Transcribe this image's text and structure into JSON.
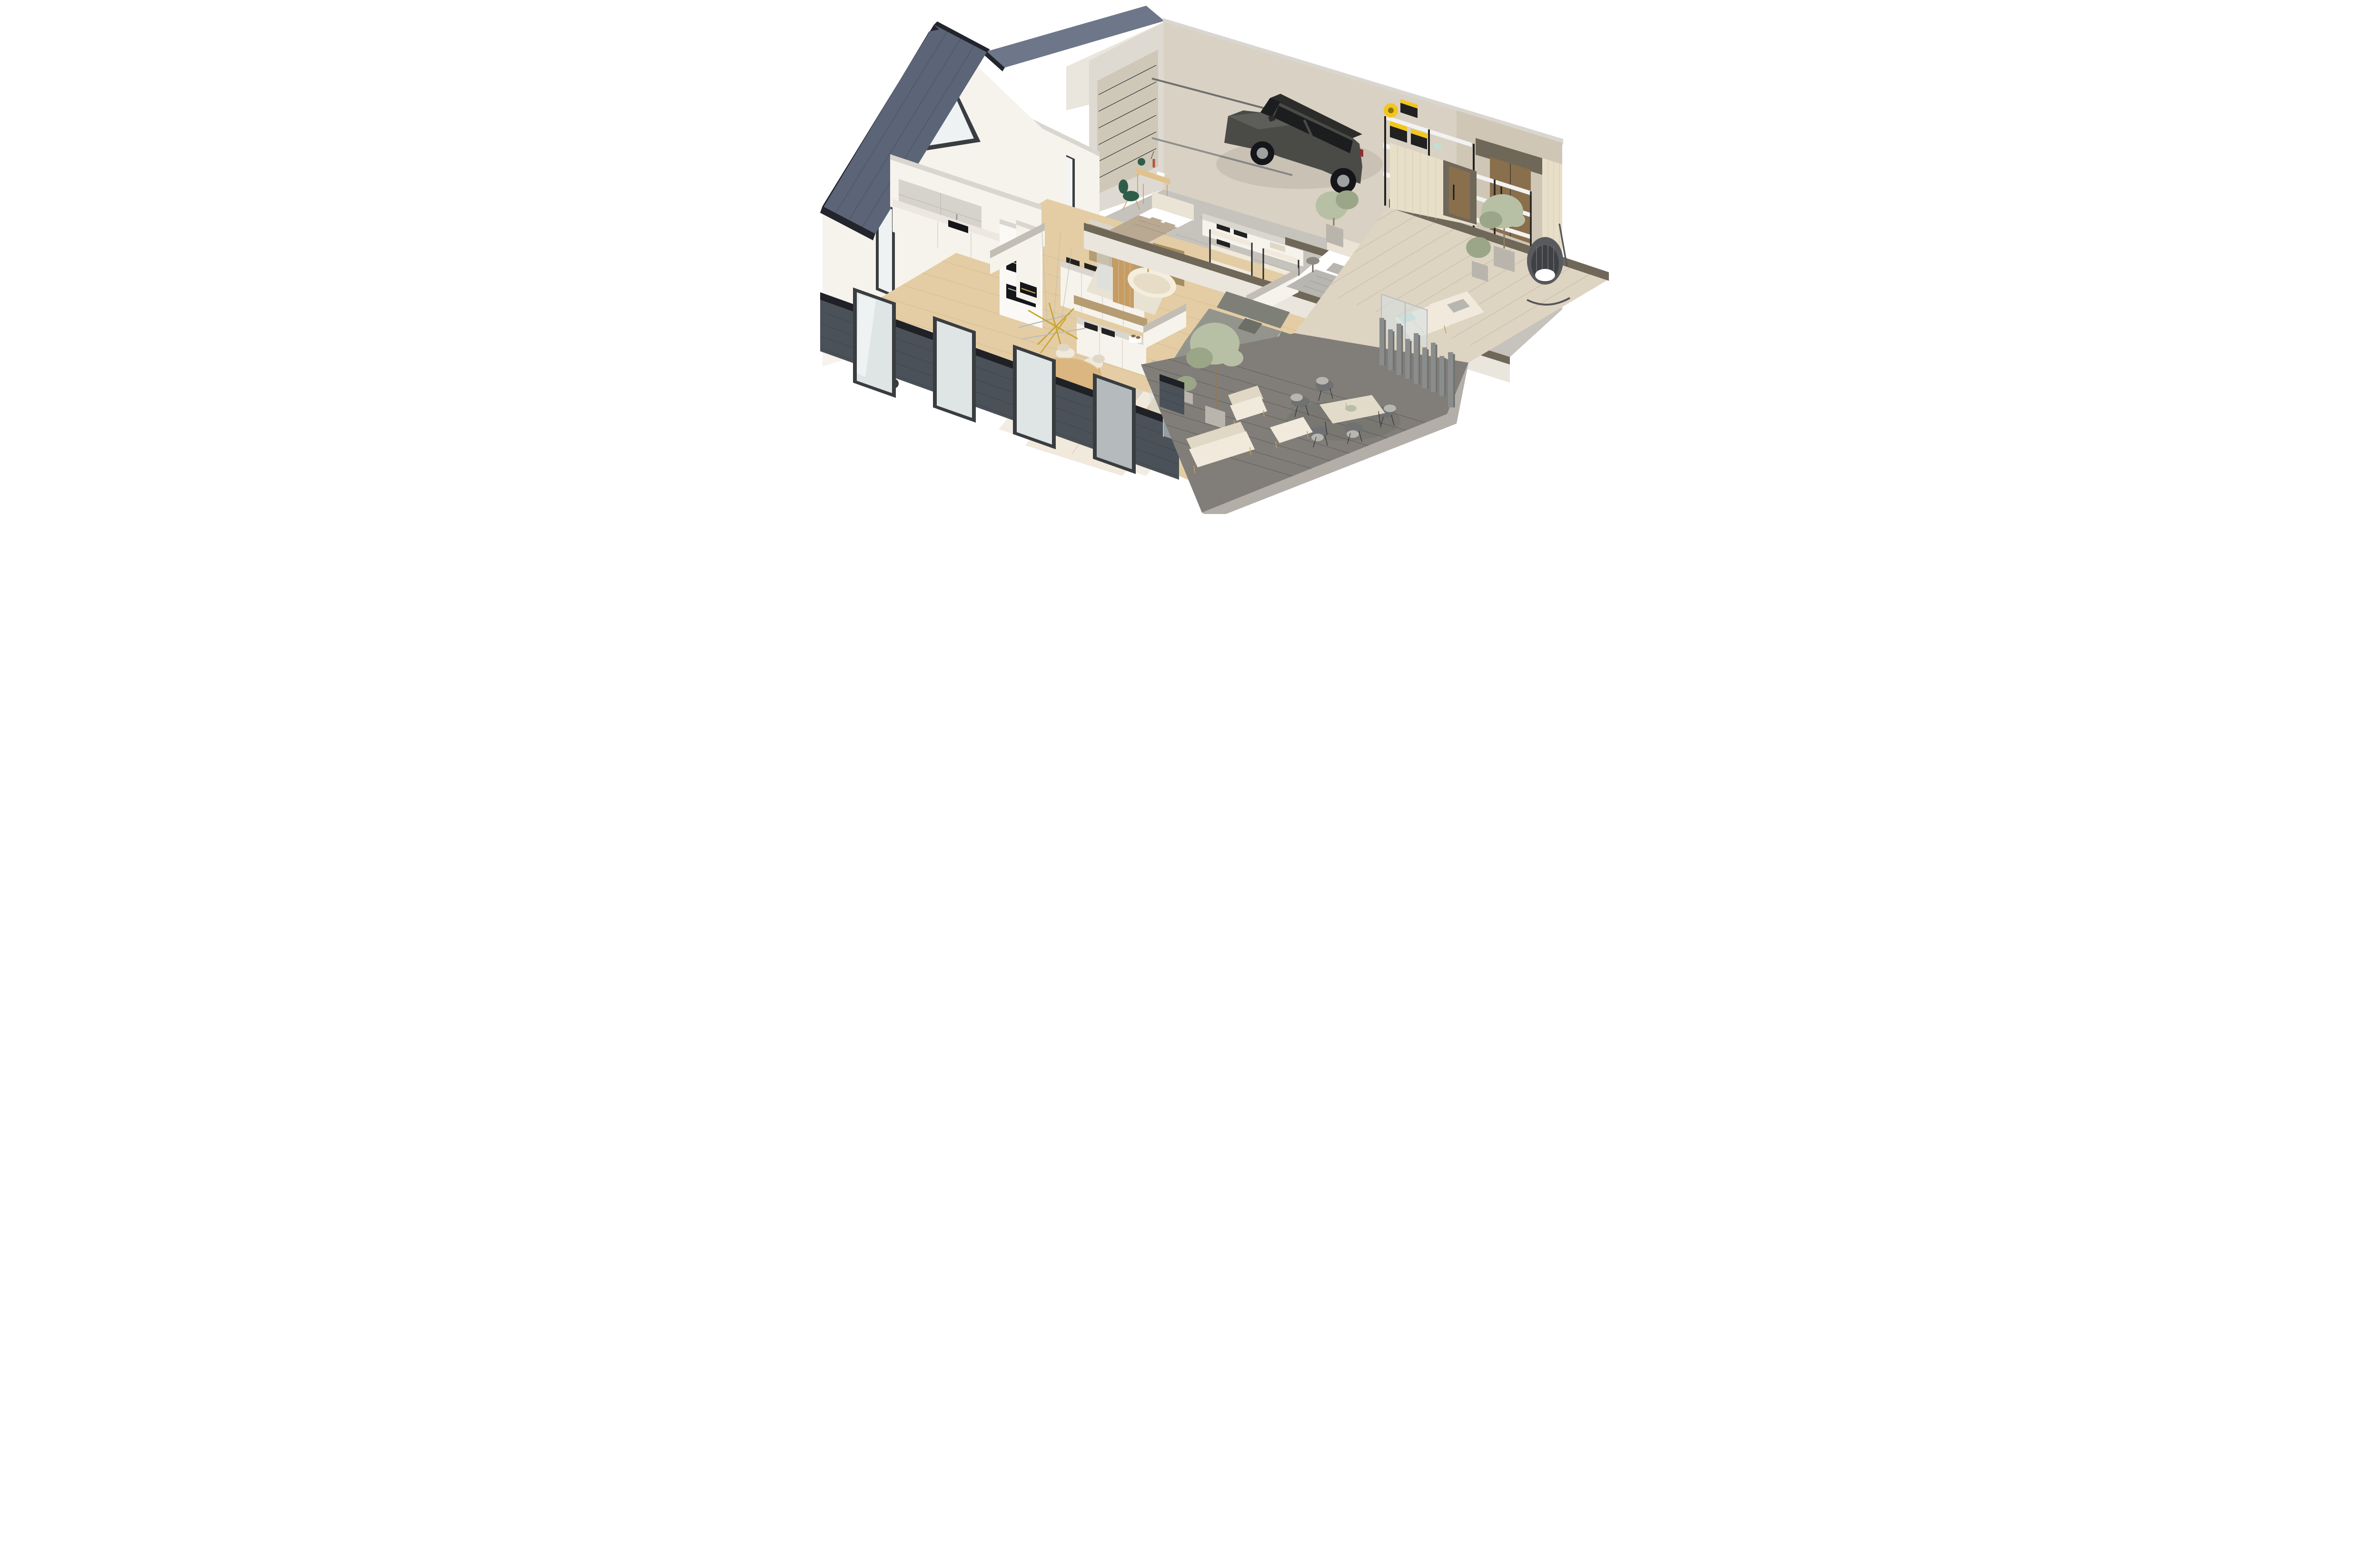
{
  "scene": {
    "type": "3d-isometric-floorplan-render",
    "description": "Isometric cutaway render of a modern single-storey house with dark slate gable roofs, dark grey brick base, white interiors, attached garage and two outdoor terraces",
    "view": "dollhouse cutaway, walls sectioned at mid height",
    "background": "#ffffff"
  },
  "palette": {
    "roof": "#5c6478",
    "roofHi": "#6e7689",
    "roofEdge": "#23252d",
    "wallWhite": "#f6f3ed",
    "wallShade": "#eae6de",
    "wallDim": "#dedad2",
    "wallTop": "#c2beb6",
    "garageWall": "#d9d1c3",
    "garageWallShade": "#cfc6b6",
    "brick": "#4b5158",
    "brickLine": "#383d43",
    "coping": "#1f2126",
    "floorWood": "#e4cda4",
    "floorLine": "#cdb186",
    "concrete": "#c6c3bd",
    "deckLight": "#ded4c2",
    "deckLightLine": "#c4b79f",
    "deckDark": "#817e79",
    "deckDarkLine": "#625f5b",
    "deckFascia": "#b3afa8",
    "glass": "rgba(213,223,226,0.55)",
    "frame": "#3a3d40",
    "frameSilver": "#b9bcbe",
    "carBody": "#4a4a47",
    "carBodyHi": "#5d5d59",
    "carDark": "#2c2c2a",
    "carGlass": "#1b1d1f",
    "sofaGrey": "#93958d",
    "sofaGreyDark": "#7e8078",
    "cream": "#f0e9dc",
    "creamShade": "#e0d7c5",
    "woodLight": "#e2c28c",
    "woodMid": "#c79c63",
    "woodDark": "#8a6f4d",
    "taupeTop": "#6f6758",
    "taupe2": "#8c8374",
    "bedTaupe": "#b9a992",
    "bedGrey": "#b8b6b1",
    "headboard": "#eae3d6",
    "tileBrown": "#b59c72",
    "tileBrownDark": "#a58c62",
    "tub": "#f4eedd",
    "brass": "#c9a430",
    "green": "#2f5d4a",
    "teal": "#bfe0d6",
    "yellow": "#f3c61b",
    "rackBlack": "#212121",
    "rackWire": "#f2f2f0",
    "olive": "#b7c0a4",
    "oliveDark": "#9aa687",
    "trunk": "#8d7a5e",
    "slatWood": "#e8dfc9",
    "slatLine": "#d2c5a9",
    "fence": "#8b8d8d",
    "fenceDark": "#6f7172",
    "planter": "#b9b5ac"
  },
  "buildings": {
    "left_wing": {
      "name": "Living wing",
      "roof": "steep dark slate standing-seam gable roof with black fascia",
      "facade": "white plaster gable with triangular window, full-height black framed glazing, dark grey brick base"
    },
    "garage_wing": {
      "name": "Garage wing",
      "roof": "dark slate gable roof (clipped at top of frame)",
      "walls": "beige rear wall, sectional garage door, timber clad entry corner"
    }
  },
  "rooms": [
    {
      "id": "garage",
      "name": "Garage",
      "floor": "grey concrete",
      "contents": [
        "graphite grey estate car",
        "beige sectional garage door with ceiling tracks",
        "black storage rack with yellow-lid tool bins",
        "yellow hose reel",
        "power tools",
        "empty wire shelving rack",
        "timber double entry door"
      ]
    },
    {
      "id": "kitchen",
      "name": "Kitchen",
      "floor": "light oak",
      "contents": [
        "white base cabinets with marble worktop",
        "grey wall cabinets",
        "tall unit with two built-in black ovens",
        "black undermount sink",
        "window breakfast bar with two cream stools",
        "dark stool",
        "island counter with black induction cooktop"
      ]
    },
    {
      "id": "dining",
      "name": "Dining area",
      "floor": "light oak",
      "contents": [
        "round wooden pedestal table",
        "six cream upholstered chairs with oak legs",
        "brass and chrome sputnik chandelier"
      ]
    },
    {
      "id": "entry",
      "name": "Entry hall / mudroom",
      "floor": "light oak",
      "contents": [
        "white wardrobe cabinets",
        "black storage trays",
        "grey box",
        "pair of brown shoes on white box",
        "white chimney column with linear fireplace"
      ]
    },
    {
      "id": "bathroom",
      "name": "Bathroom",
      "floor": "beige tile",
      "contents": [
        "freestanding cream bathtub with brass filler",
        "brown tiled walls",
        "oak partition panel",
        "glass shower screen"
      ]
    },
    {
      "id": "bedroom-study",
      "name": "Bedroom / study",
      "floor": "light oak",
      "contents": [
        "double bed with white headboard and taupe quilt",
        "white and taupe pillows",
        "oak writing desk",
        "green dome table lamp",
        "red vase with dried stems",
        "dark green swivel chair",
        "tall black framed windows"
      ]
    },
    {
      "id": "closet",
      "name": "Walk-in closet",
      "contents": [
        "cream shelving racks with black posts",
        "folded dark clothing",
        "shoe shelves",
        "beige storage boxes"
      ]
    },
    {
      "id": "master-bedroom",
      "name": "Master bedroom",
      "floor": "light oak",
      "contents": [
        "double bed with twin cream headboard panels",
        "grey duvet and pillows",
        "round grey side table",
        "sliding glass door to terrace",
        "light timber slat wall"
      ]
    },
    {
      "id": "tv-lounge",
      "name": "TV lounge / study nook",
      "floor": "light oak",
      "contents": [
        "grey corner sofa with chaise",
        "oak desk with brass lamp and amber vase",
        "dark green chair",
        "oak sideboard with dark top and rows of books",
        "white media half-wall with wall-mounted TV",
        "open white shelving"
      ]
    },
    {
      "id": "living",
      "name": "Living room",
      "floor": "light oak",
      "contents": [
        "large cream modular lounge sofa",
        "cream ottoman with throw",
        "cream rug",
        "glass sliding doors",
        "glass balustrade",
        "dark brick window piers"
      ]
    },
    {
      "id": "terrace-upper",
      "name": "Upper terrace (light deck)",
      "floor": "pale timber decking",
      "contents": [
        "hanging egg chair on stand",
        "two cream sun loungers with teal pillow and grey towel",
        "potted olive trees in grey planters",
        "timber slat privacy wall with recessed timber door"
      ]
    },
    {
      "id": "terrace-lower",
      "name": "Lower terrace (dark deck)",
      "floor": "dark grey decking",
      "contents": [
        "outdoor dining table with stone-look top",
        "five dark rope chairs with light cushions",
        "table centrepiece",
        "white outdoor armchair",
        "white outdoor sofa",
        "white ottoman",
        "tall potted olive tree",
        "staggered grey fence pylons"
      ]
    }
  ],
  "vehicle": {
    "type": "estate car",
    "colour": "graphite grey",
    "parked_in": "garage"
  }
}
